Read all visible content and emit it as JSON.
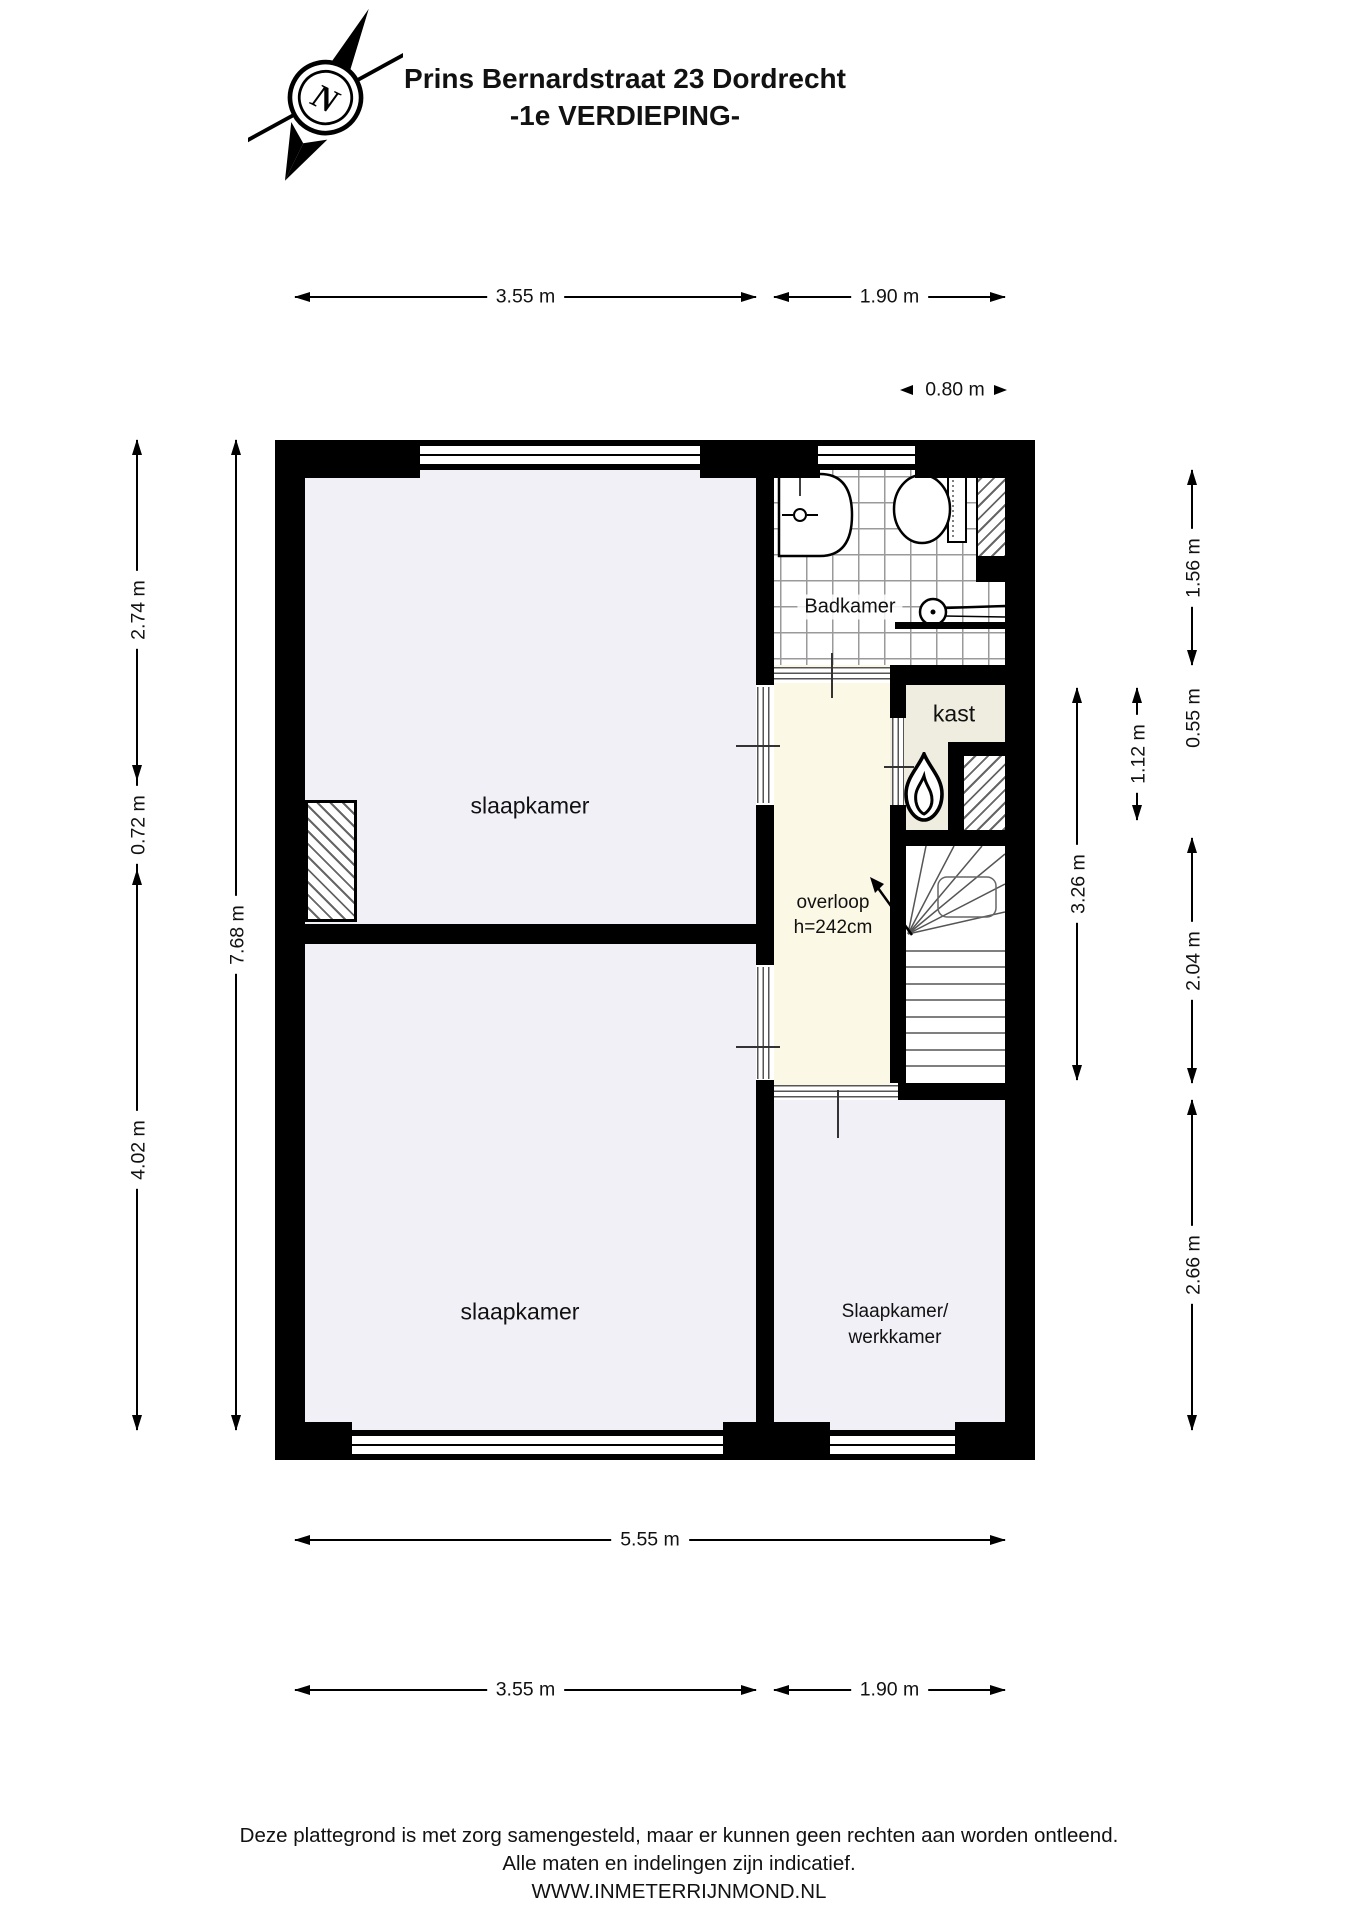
{
  "title": {
    "line1": "Prins Bernardstraat 23 Dordrecht",
    "line2": "-1e VERDIEPING-"
  },
  "compass": {
    "label": "N"
  },
  "rooms": {
    "slaapkamer_top": "slaapkamer",
    "slaapkamer_bottom": "slaapkamer",
    "badkamer": "Badkamer",
    "kast": "kast",
    "overloop": "overloop",
    "overloop_height": "h=242cm",
    "werkkamer_line1": "Slaapkamer/",
    "werkkamer_line2": "werkkamer"
  },
  "dimensions": {
    "top_left_width": "3.55 m",
    "top_right_width": "1.90 m",
    "badkamer_niche_width": "0.80 m",
    "left_top": "2.74 m",
    "left_mid": "0.72 m",
    "left_bottom": "4.02 m",
    "left_total": "7.68 m",
    "right_overloop": "3.26 m",
    "right_kast": "1.12 m",
    "right_badkamer": "1.56 m",
    "right_kast_top": "0.55 m",
    "right_stairs": "2.04 m",
    "right_room": "2.66 m",
    "bottom_total": "5.55 m",
    "bottom_left_width": "3.55 m",
    "bottom_right_width": "1.90 m"
  },
  "footer": {
    "line1": "Deze plattegrond is met zorg samengesteld, maar er kunnen geen rechten aan worden ontleend.",
    "line2": "Alle maten en indelingen zijn indicatief.",
    "line3": "WWW.INMETERRIJNMOND.NL"
  },
  "colors": {
    "wall": "#000000",
    "room_fill": "#f1f0f6",
    "hall_fill": "#fbf8e6",
    "closet_fill": "#efede0",
    "tile_line": "#9a9a9a"
  }
}
